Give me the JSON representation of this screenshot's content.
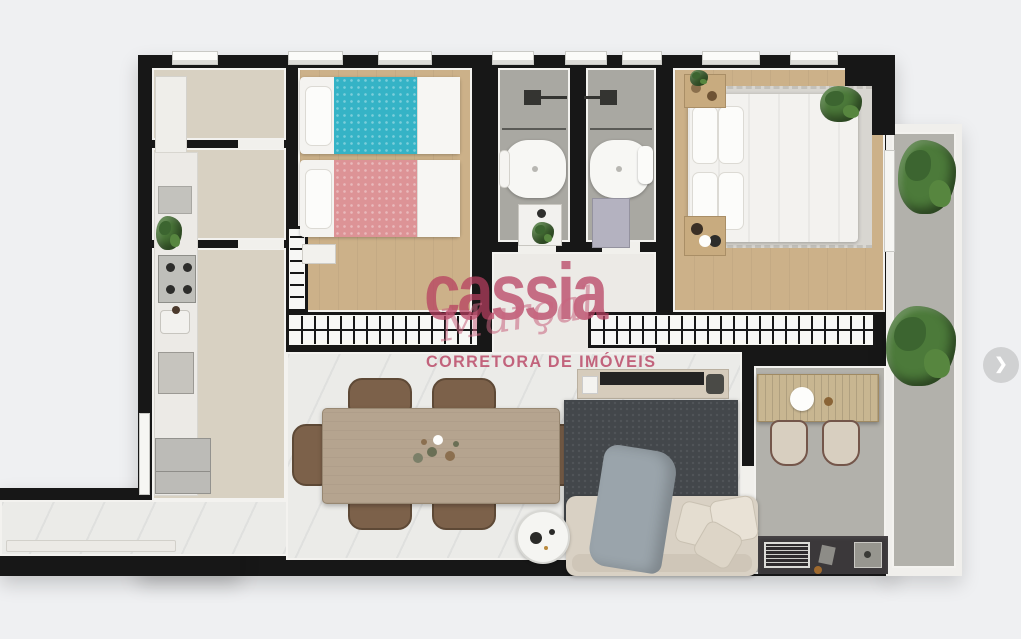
{
  "watermark": {
    "brand": "cassia",
    "script": "Marçal",
    "tagline": "CORRETORA DE IMÓVEIS"
  },
  "carousel": {
    "next_icon": "❯"
  },
  "palette": {
    "background": "#eff0f2",
    "wall": "#171717",
    "trim": "#f3f2ef",
    "wood_floor": "#ccb189",
    "beige_floor": "#d8d1c2",
    "tile_gray": "#a9a8a2",
    "balcony_gray": "#b2b1ab",
    "marble_floor": "#ebebe8",
    "accent_pink": "#b73e5f",
    "teal_bed": "#35b3c6",
    "pink_bed": "#dd9396",
    "rug_dark": "#43474b",
    "sofa_beige": "#d9d1c4",
    "chair_brown": "#7c614a",
    "table_wood": "#b5a48f",
    "plant_green": "#4c7a3a",
    "counter_dark": "#3b383a"
  }
}
